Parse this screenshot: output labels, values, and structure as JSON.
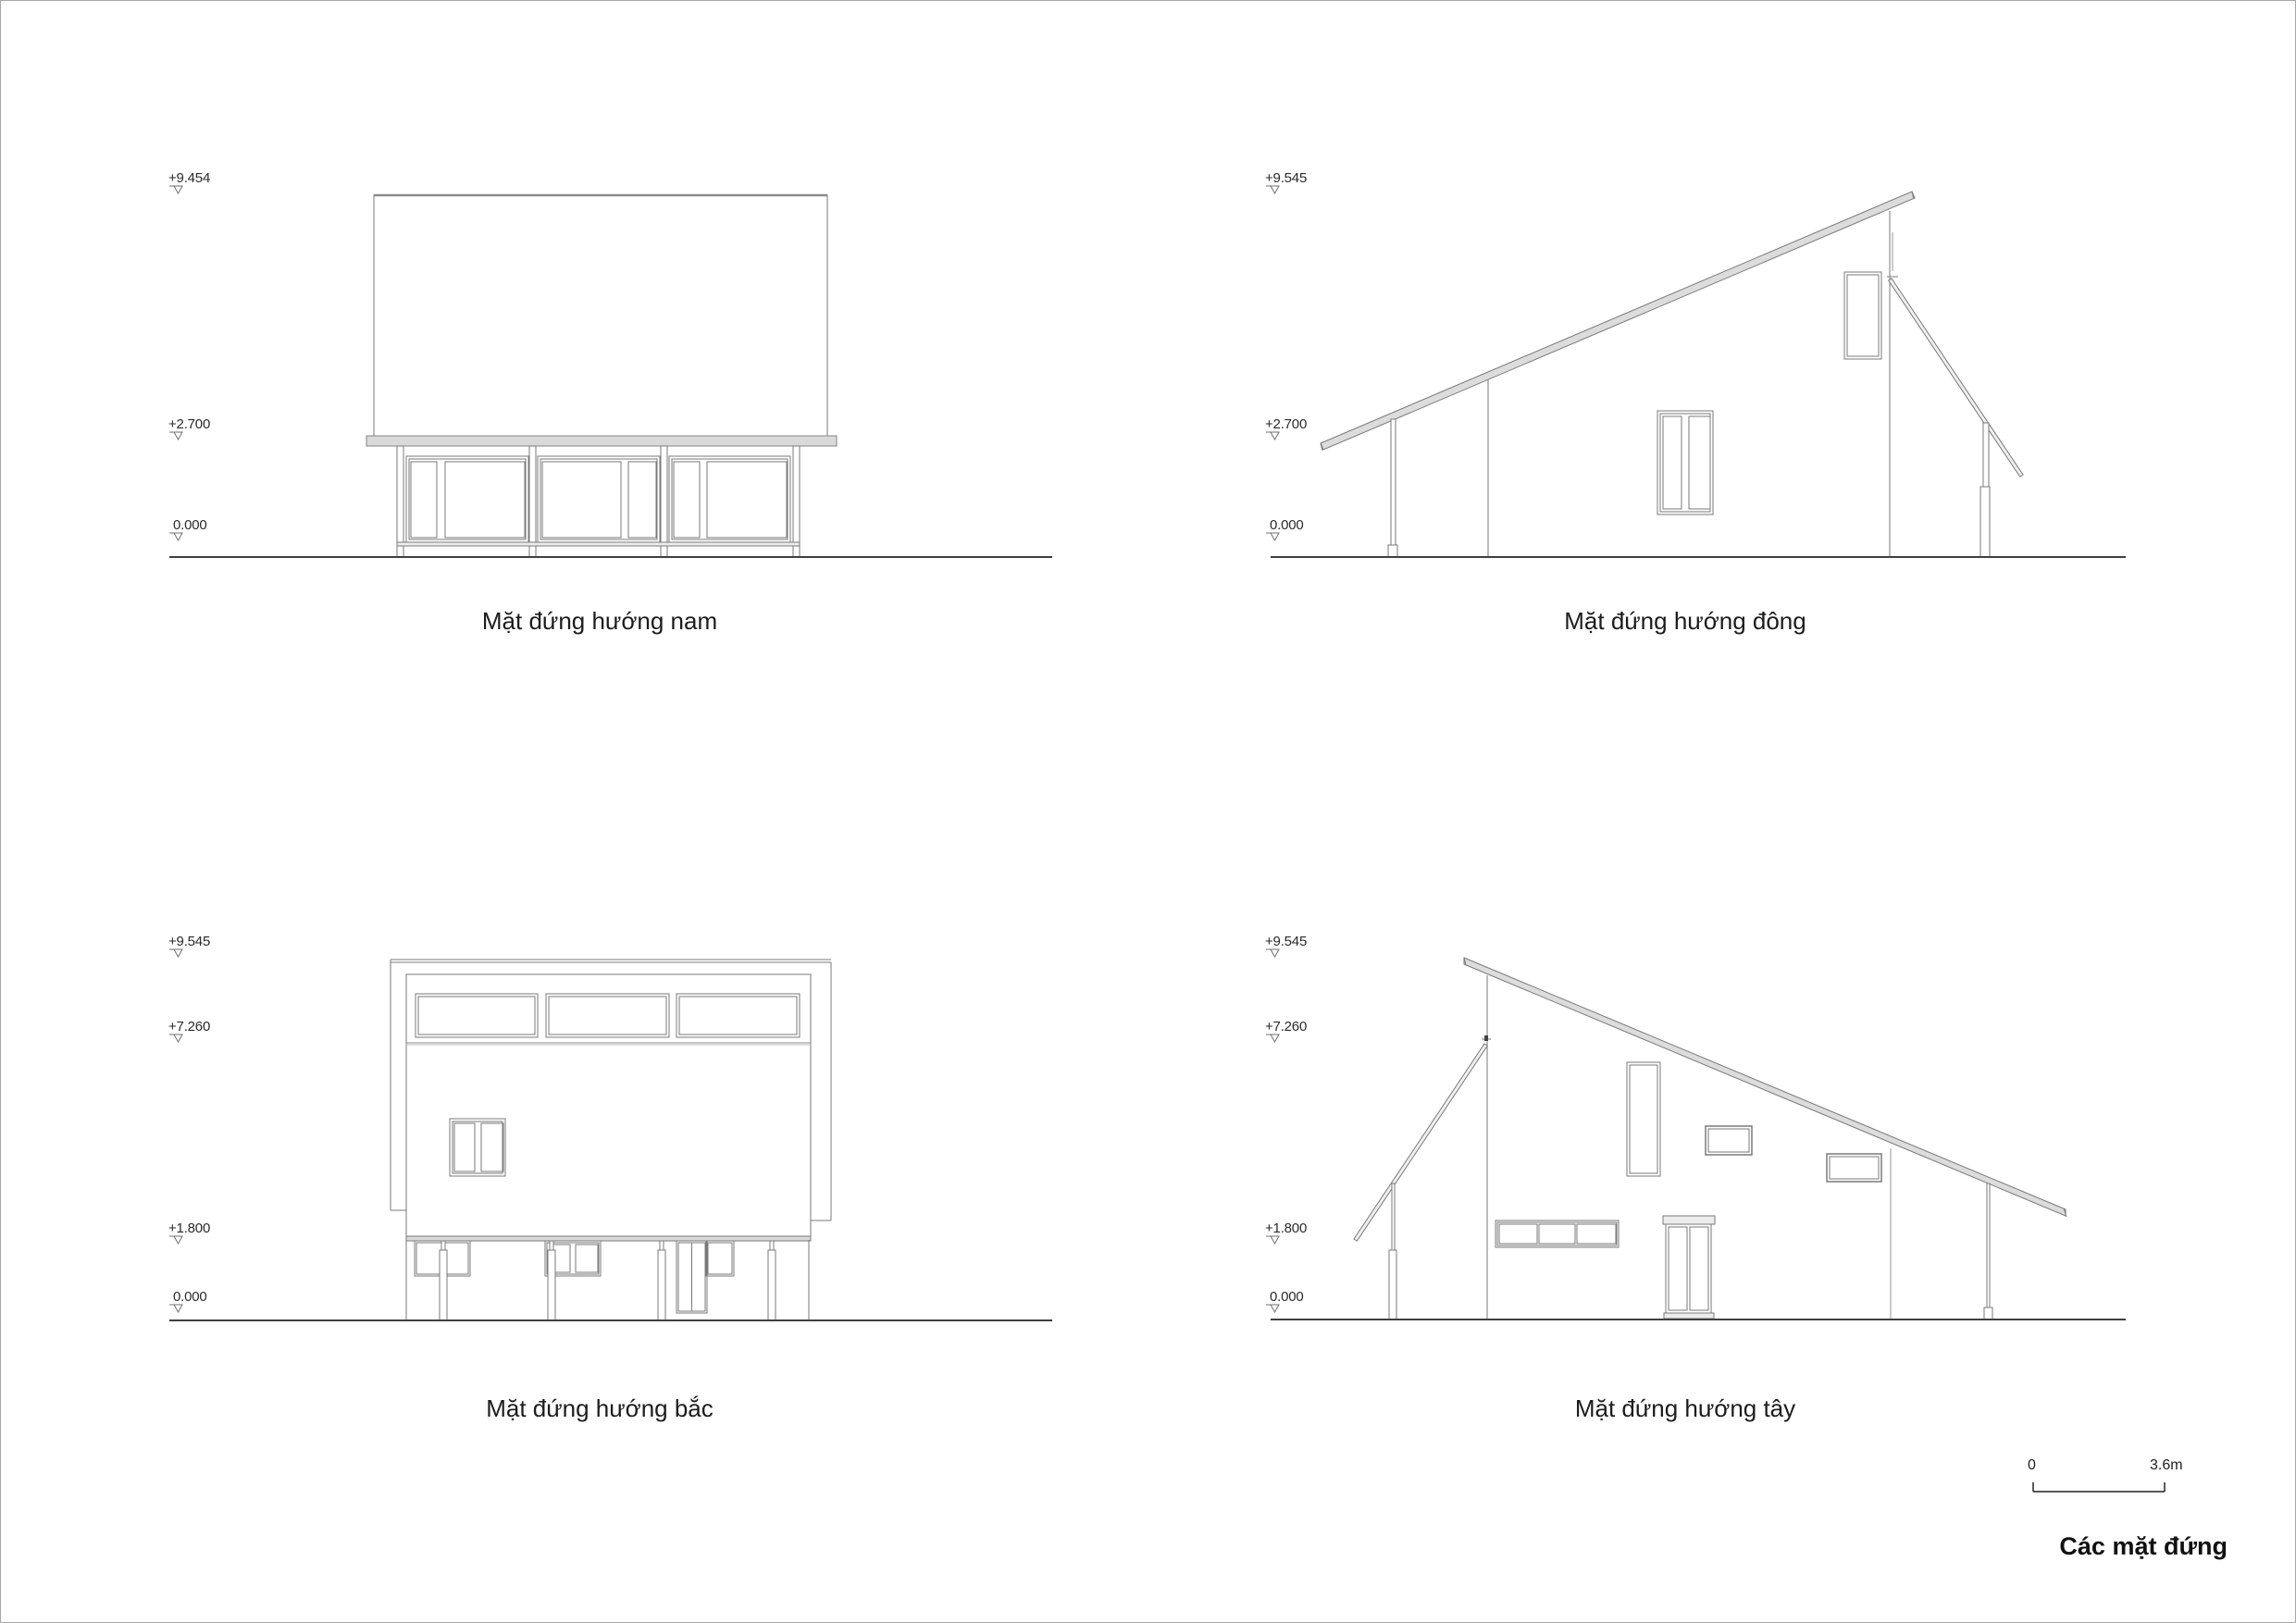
{
  "drawing_colors": {
    "line": "#7a7a7a",
    "roof_fill": "#dcdcdc",
    "slab_fill": "#d9d9d9",
    "ground": "#3f3f3f",
    "text": "#1f1f1f"
  },
  "elevations": [
    {
      "id": "south",
      "caption": "Mặt đứng hướng nam",
      "levels": [
        {
          "label": "+9.454"
        },
        {
          "label": "+2.700"
        },
        {
          "label": "0.000"
        }
      ]
    },
    {
      "id": "east",
      "caption": "Mặt đứng hướng đông",
      "levels": [
        {
          "label": "+9.545"
        },
        {
          "label": "+2.700"
        },
        {
          "label": "0.000"
        }
      ]
    },
    {
      "id": "north",
      "caption": "Mặt đứng hướng bắc",
      "levels": [
        {
          "label": "+9.545"
        },
        {
          "label": "+7.260"
        },
        {
          "label": "+1.800"
        },
        {
          "label": "0.000"
        }
      ]
    },
    {
      "id": "west",
      "caption": "Mặt đứng hướng tây",
      "levels": [
        {
          "label": "+9.545"
        },
        {
          "label": "+7.260"
        },
        {
          "label": "+1.800"
        },
        {
          "label": "0.000"
        }
      ]
    }
  ],
  "scale_bar": {
    "zero_label": "0",
    "end_label": "3.6m"
  },
  "sheet_title": "Các mặt đứng"
}
